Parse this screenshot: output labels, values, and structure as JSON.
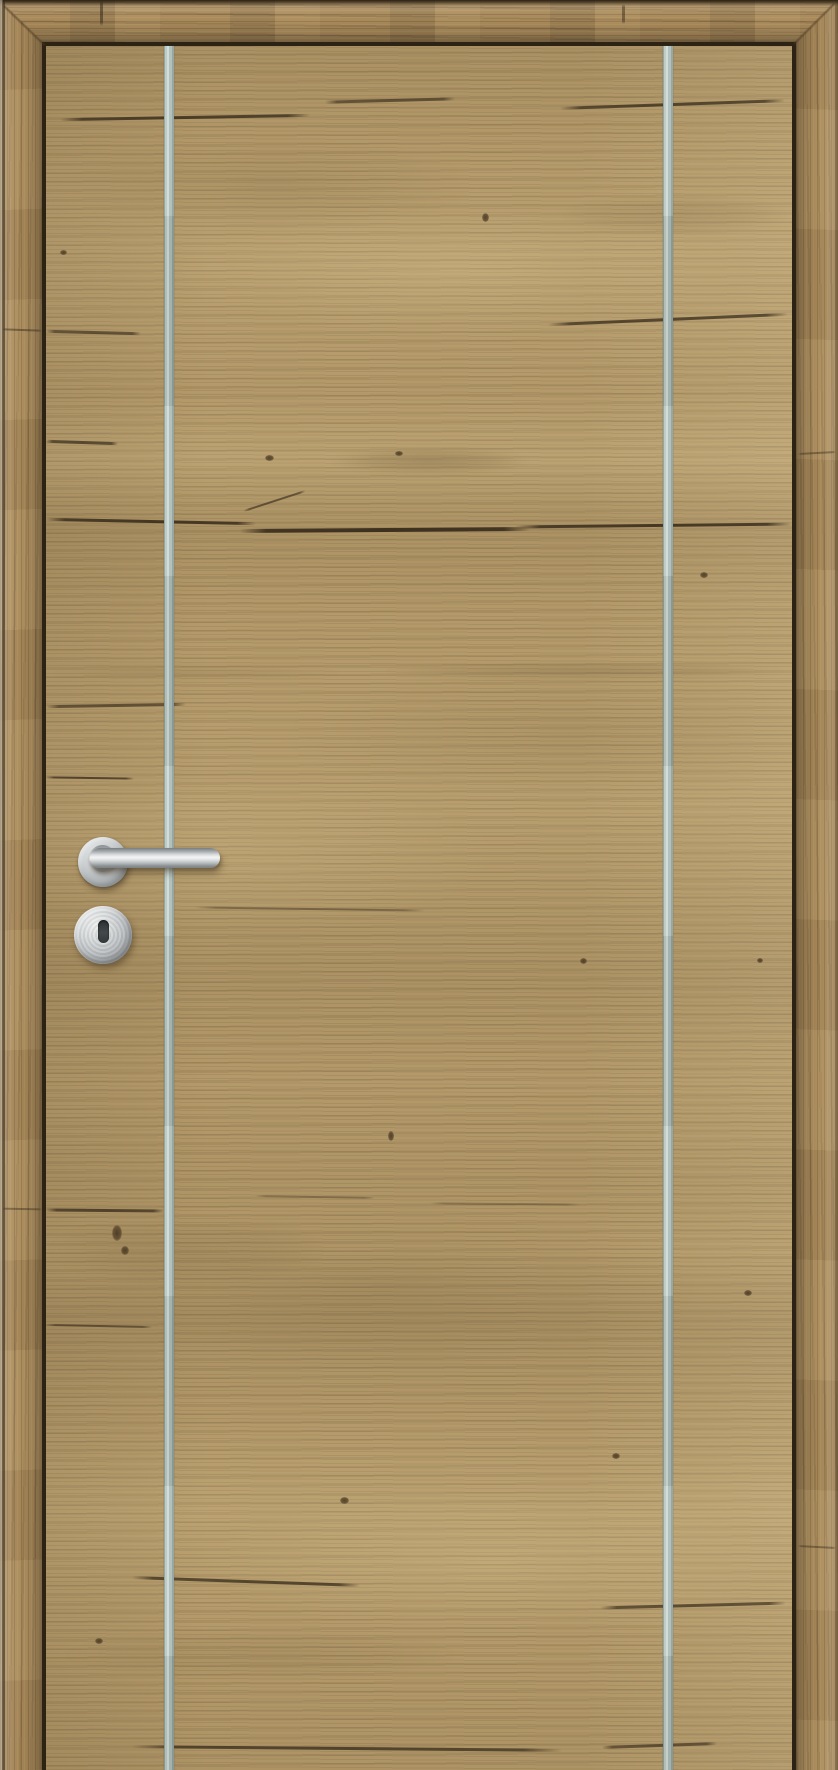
{
  "scene": {
    "type": "product-photo",
    "description": "Catalog photograph of a closed single interior door in rustic knotty oak with horizontal grain and visible cracks. Two vertical brushed-aluminium inlay strips run the full height of the leaf. A brushed stainless-steel straight lever handle on a round rosette sits on the left side with a matching round keyhole escutcheon below it. A matching oak casing frames the leaf on the left, top and right with mitred corners.",
    "handle_position": "left",
    "objects": [
      {
        "name": "door-frame",
        "material": "oak casing, mitred corners, vertical grain on jambs"
      },
      {
        "name": "door-leaf",
        "material": "rustic oak, horizontal grain with cracks and knots"
      },
      {
        "name": "inlay-strip-left",
        "material": "brushed aluminium, full height"
      },
      {
        "name": "inlay-strip-right",
        "material": "brushed aluminium, full height"
      },
      {
        "name": "lever-handle",
        "material": "brushed stainless steel, straight lever on round rosette"
      },
      {
        "name": "keyhole-escutcheon",
        "material": "brushed stainless steel, round, vertical key slot"
      }
    ]
  },
  "colors": {
    "frame-wood": "#a8895a",
    "frame-wood-dark": "#6d5637",
    "frame-wood-light": "#c2a874",
    "door-wood": "#b49a6a",
    "door-wood-light": "#c9b284",
    "door-wood-dark": "#937b50",
    "crack": "#33281a",
    "gap-shadow": "#2c2314",
    "inlay": "#adbcb7",
    "inlay-highlight": "#cfdad5",
    "inlay-edge": "#8da09b",
    "metal-bright": "#f3f5f5",
    "metal-mid": "#b4b9bb",
    "metal-dark": "#8a8f92",
    "keyhole": "#43484b"
  },
  "texture": {
    "cracks": [
      {
        "x": 60,
        "y": 116,
        "w": 250,
        "rot": -1,
        "o": 0.75
      },
      {
        "x": 325,
        "y": 99,
        "w": 130,
        "rot": -1.5,
        "o": 0.6
      },
      {
        "x": 560,
        "y": 103,
        "w": 225,
        "rot": -2,
        "o": 0.7
      },
      {
        "x": 46,
        "y": 331,
        "w": 95,
        "rot": 1.5,
        "o": 0.6
      },
      {
        "x": 548,
        "y": 318,
        "w": 240,
        "rot": -2.5,
        "o": 0.7
      },
      {
        "x": 46,
        "y": 441,
        "w": 72,
        "rot": 2,
        "o": 0.65
      },
      {
        "x": 46,
        "y": 520,
        "w": 210,
        "rot": 1.2,
        "o": 0.8
      },
      {
        "x": 240,
        "y": 528,
        "w": 290,
        "h": 4,
        "rot": -0.4,
        "o": 0.85
      },
      {
        "x": 515,
        "y": 524,
        "w": 277,
        "rot": -0.6,
        "o": 0.8
      },
      {
        "x": 242,
        "y": 500,
        "w": 65,
        "h": 2,
        "rot": -18,
        "o": 0.6
      },
      {
        "x": 46,
        "y": 704,
        "w": 140,
        "rot": -1,
        "o": 0.6
      },
      {
        "x": 46,
        "y": 777,
        "w": 88,
        "h": 2,
        "rot": 0.8,
        "o": 0.7
      },
      {
        "x": 195,
        "y": 908,
        "w": 230,
        "h": 2,
        "rot": 0.8,
        "o": 0.4
      },
      {
        "x": 46,
        "y": 1209,
        "w": 118,
        "rot": 0.5,
        "o": 0.7
      },
      {
        "x": 255,
        "y": 1196,
        "w": 120,
        "h": 2,
        "rot": 1,
        "o": 0.3
      },
      {
        "x": 430,
        "y": 1203,
        "w": 150,
        "h": 2,
        "rot": 0.5,
        "o": 0.28
      },
      {
        "x": 46,
        "y": 1325,
        "w": 106,
        "h": 2,
        "rot": 1.2,
        "o": 0.55
      },
      {
        "x": 132,
        "y": 1580,
        "w": 228,
        "rot": 2,
        "o": 0.7
      },
      {
        "x": 600,
        "y": 1604,
        "w": 186,
        "rot": -1.5,
        "o": 0.65
      },
      {
        "x": 132,
        "y": 1747,
        "w": 430,
        "rot": 0.5,
        "o": 0.7
      },
      {
        "x": 602,
        "y": 1744,
        "w": 115,
        "rot": -2,
        "o": 0.6
      },
      {
        "x": 100,
        "y": 0,
        "w": 3,
        "h": 26,
        "v": true,
        "o": 0.5
      },
      {
        "x": 622,
        "y": 4,
        "w": 3,
        "h": 20,
        "v": true,
        "o": 0.45
      },
      {
        "x": 2,
        "y": 329,
        "w": 40,
        "h": 2,
        "rot": 2,
        "o": 0.45
      },
      {
        "x": 2,
        "y": 1208,
        "w": 40,
        "h": 2,
        "rot": 1,
        "o": 0.4
      },
      {
        "x": 798,
        "y": 452,
        "w": 38,
        "h": 2,
        "rot": -3,
        "o": 0.4
      },
      {
        "x": 798,
        "y": 1546,
        "w": 38,
        "h": 2,
        "rot": 3,
        "o": 0.4
      }
    ],
    "knots": [
      {
        "x": 265,
        "y": 455,
        "w": 9,
        "h": 6
      },
      {
        "x": 395,
        "y": 451,
        "w": 8,
        "h": 5
      },
      {
        "x": 482,
        "y": 213,
        "w": 7,
        "h": 9
      },
      {
        "x": 700,
        "y": 572,
        "w": 8,
        "h": 6
      },
      {
        "x": 388,
        "y": 1131,
        "w": 6,
        "h": 10
      },
      {
        "x": 112,
        "y": 1225,
        "w": 10,
        "h": 16
      },
      {
        "x": 121,
        "y": 1246,
        "w": 8,
        "h": 9
      },
      {
        "x": 744,
        "y": 1290,
        "w": 8,
        "h": 6
      },
      {
        "x": 340,
        "y": 1497,
        "w": 9,
        "h": 7
      },
      {
        "x": 612,
        "y": 1453,
        "w": 8,
        "h": 6
      },
      {
        "x": 95,
        "y": 1638,
        "w": 8,
        "h": 6
      },
      {
        "x": 580,
        "y": 958,
        "w": 7,
        "h": 6
      },
      {
        "x": 757,
        "y": 958,
        "w": 6,
        "h": 5
      },
      {
        "x": 60,
        "y": 250,
        "w": 7,
        "h": 5
      }
    ],
    "streaks": [
      {
        "x": 380,
        "y": 664,
        "w": 410,
        "h": 14,
        "o": 0.18
      },
      {
        "x": 46,
        "y": 668,
        "w": 300,
        "h": 10,
        "o": 0.12
      },
      {
        "x": 330,
        "y": 448,
        "w": 200,
        "h": 26,
        "o": 0.2
      },
      {
        "x": 46,
        "y": 1215,
        "w": 280,
        "h": 70,
        "o": 0.1
      },
      {
        "x": 560,
        "y": 195,
        "w": 230,
        "h": 40,
        "o": 0.1
      },
      {
        "x": 60,
        "y": 1630,
        "w": 400,
        "h": 50,
        "o": 0.08
      }
    ]
  }
}
